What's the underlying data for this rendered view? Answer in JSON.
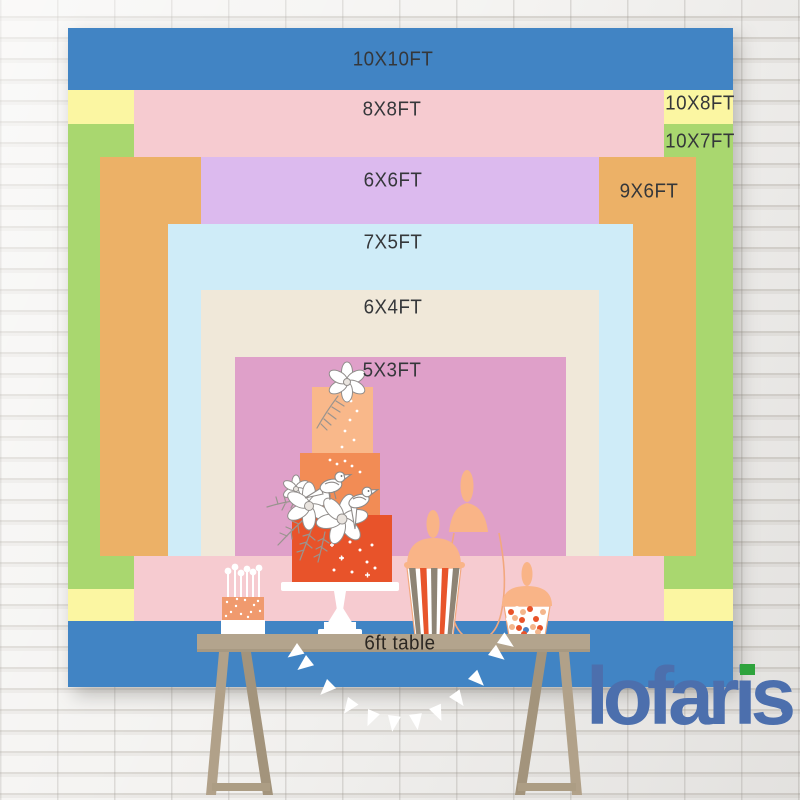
{
  "backdrop": {
    "description": "nested backdrop size chart on white brick wall",
    "layers": [
      {
        "id": "10x10ft",
        "label": "10X10FT",
        "color": "#4184c4"
      },
      {
        "id": "10x8ft",
        "label": "10X8FT",
        "color": "#fbf6a2"
      },
      {
        "id": "10x7ft",
        "label": "10X7FT",
        "color": "#a9d76f"
      },
      {
        "id": "8x8ft",
        "label": "8X8FT",
        "color": "#f6cbd0"
      },
      {
        "id": "9x6ft",
        "label": "9X6FT",
        "color": "#ecb167"
      },
      {
        "id": "6x6ft",
        "label": "6X6FT",
        "color": "#dcbaee"
      },
      {
        "id": "7x5ft",
        "label": "7X5FT",
        "color": "#cfecf8"
      },
      {
        "id": "6x4ft",
        "label": "6X4FT",
        "color": "#f0e8d9"
      },
      {
        "id": "5x3ft",
        "label": "5X3FT",
        "color": "#dfa0c9"
      }
    ],
    "label_color": "#35373a"
  },
  "table": {
    "label": "6ft table",
    "surface_color": "#b3a48d"
  },
  "logo": {
    "text": "lofaris",
    "color": "#4c6fad",
    "flag_color": "#2ea33c"
  },
  "scene": {
    "items": [
      "three-tier-cake",
      "cake-stand",
      "flower-and-bird-decor",
      "cake-pops-stand",
      "apothecary-jar-outline",
      "striped-popcorn-jar",
      "candy-jar",
      "pennant-bunting",
      "trestle-legs"
    ]
  }
}
